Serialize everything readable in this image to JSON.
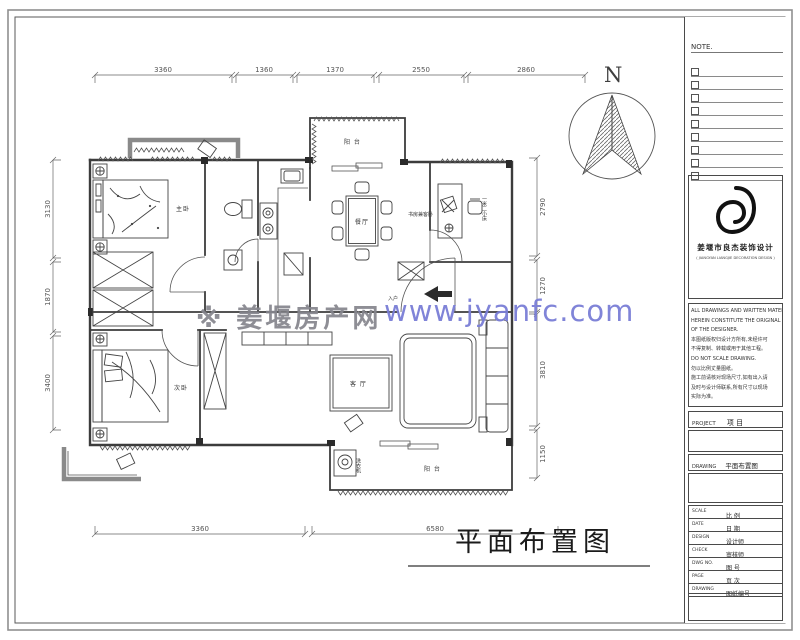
{
  "title": "平面布置图",
  "north_label": "N",
  "watermark": {
    "site": "※ 姜堰房产网",
    "url": "www.jyanfc.com"
  },
  "dimensions": {
    "top": [
      "3360",
      "1360",
      "1370",
      "2550",
      "2860"
    ],
    "bottom": [
      "3360",
      "6580"
    ],
    "left": [
      "3130",
      "1870",
      "3400"
    ],
    "right": [
      "2790",
      "1270",
      "3810",
      "1150"
    ]
  },
  "rooms": {
    "balcony_top": "阳 台",
    "dining": "餐厅",
    "study": "书房兼客卧",
    "study_note": "一米二小床",
    "living": "客 厅",
    "bedroom_master": "主卧",
    "bedroom_second": "次卧",
    "balcony_bottom": "阳 台",
    "entry": "入户",
    "washer": "洗衣机"
  },
  "panel": {
    "note_label": "NOTE.",
    "company": "姜堰市良杰装饰设计",
    "company_en": "( JIANGYAN LIANGJIE DECORATION DESIGN )",
    "notes": [
      "ALL DRAWINGS AND WRITTEN MATERIAL",
      "HEREIN CONSTITUTE THE ORIGINAL WORK",
      "OF THE DESIGNER.",
      "本图纸版权归设计方所有,未经许可",
      "不得复制、转载或用于其他工程。",
      "DO NOT SCALE DRAWING.",
      "勿以比例丈量图纸。",
      "施工前请核对现场尺寸,如有出入请",
      "及时与设计师联系,所有尺寸以现场",
      "实际为准。"
    ],
    "project_label": "PROJECT",
    "project_cn": "项  目",
    "drawing_label": "DRAWING",
    "drawing_value": "平面布置图",
    "fields": [
      [
        "SCALE",
        "比 例"
      ],
      [
        "DATE",
        "日 期"
      ],
      [
        "DESIGN",
        "设计师"
      ],
      [
        "CHECK",
        "审核师"
      ],
      [
        "DWG NO.",
        "图 号"
      ],
      [
        "PAGE",
        "页 次"
      ],
      [
        "DRAWING",
        "图纸编号"
      ]
    ]
  },
  "colors": {
    "watermark_site": "#85858d",
    "watermark_url": "#7a7ed6",
    "wall": "#3c3c3c",
    "wall_gray": "#8a8a8a"
  }
}
